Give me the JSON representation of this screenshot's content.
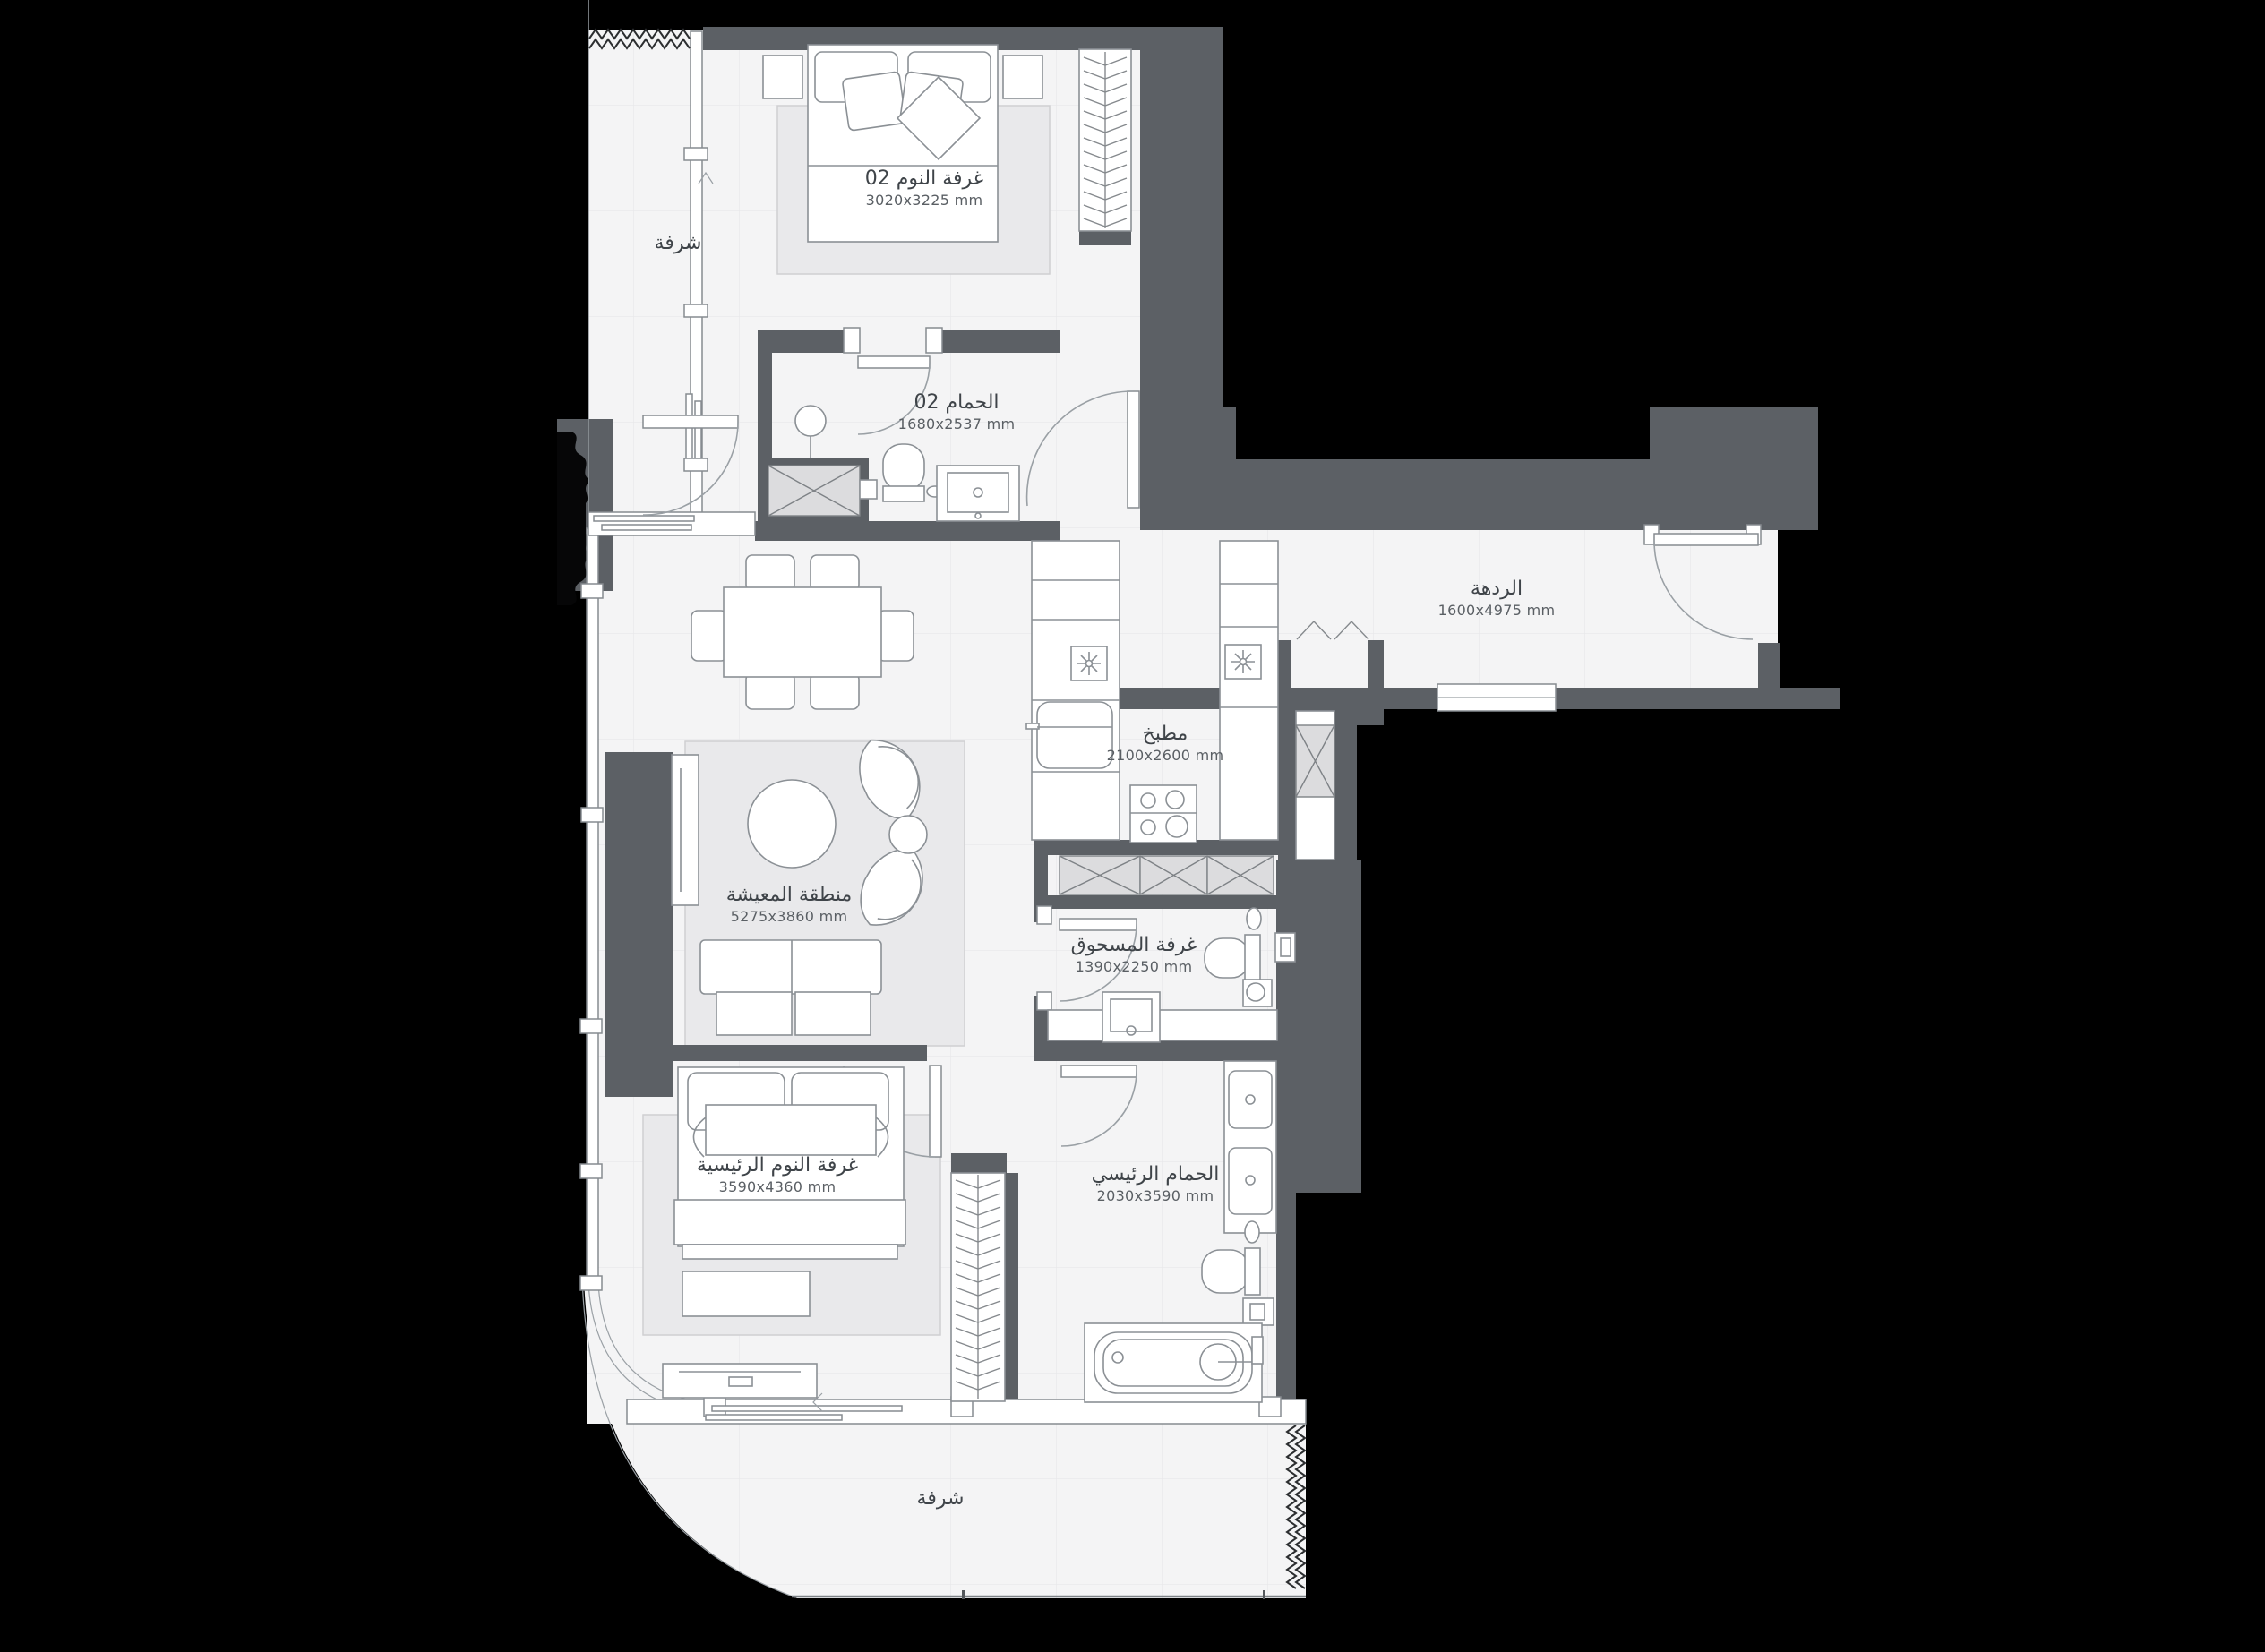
{
  "plan_title": "apartment-floor-plan",
  "rooms": [
    {
      "id": "bedroom-02",
      "name": "غرفة النوم 02",
      "dims": "3020x3225 mm"
    },
    {
      "id": "bathroom-02",
      "name": "الحمام 02",
      "dims": "1680x2537 mm"
    },
    {
      "id": "hallway",
      "name": "الردهة",
      "dims": "1600x4975 mm"
    },
    {
      "id": "kitchen",
      "name": "مطبخ",
      "dims": "2100x2600 mm"
    },
    {
      "id": "living-area",
      "name": "منطقة المعيشة",
      "dims": "5275x3860 mm"
    },
    {
      "id": "powder-room",
      "name": "غرفة المسحوق",
      "dims": "1390x2250 mm"
    },
    {
      "id": "master-bedroom",
      "name": "غرفة النوم الرئيسية",
      "dims": "3590x4360 mm"
    },
    {
      "id": "master-bathroom",
      "name": "الحمام الرئيسي",
      "dims": "2030x3590 mm"
    },
    {
      "id": "balcony-top",
      "name": "شرفة",
      "dims": ""
    },
    {
      "id": "balcony-bottom",
      "name": "شرفة",
      "dims": ""
    }
  ],
  "colors": {
    "background": "#000000",
    "wall": "#5c6065",
    "floor": "#f4f4f5",
    "rug": "#e9e9eb",
    "furniture_stroke": "#8b9095",
    "label_text": "#3f4449"
  }
}
